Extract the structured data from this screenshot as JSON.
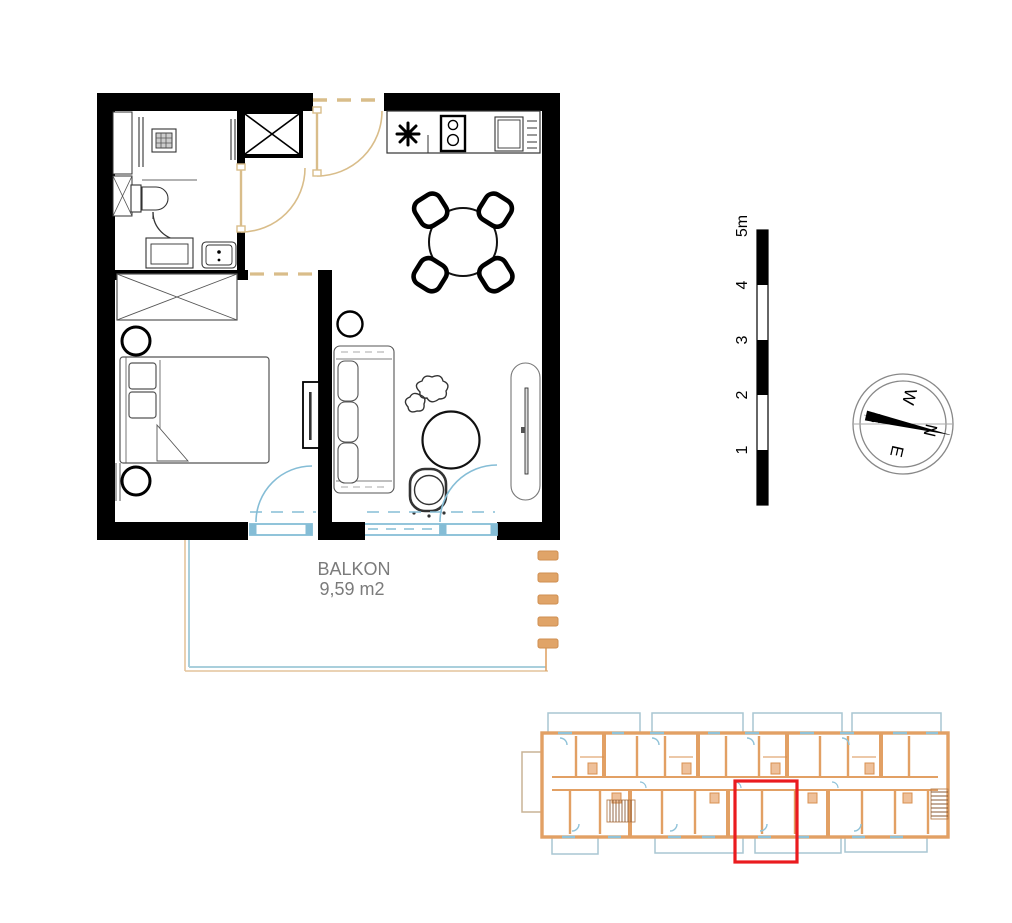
{
  "floor_plan": {
    "balcony_label": "BALKON",
    "balcony_area": "9,59 m2"
  },
  "scale_bar": {
    "labels": [
      "1",
      "2",
      "3",
      "4",
      "5m"
    ]
  },
  "compass": {
    "north": "N",
    "east": "E",
    "south": "S",
    "west": "W"
  },
  "colors": {
    "wall": "#000000",
    "interior_door": "#dcc18e",
    "balcony_door": "#85bdd6",
    "balcony_outline": "#a9cfdc",
    "balcony_rail": "#e0a468",
    "label_text": "#7b7b7b",
    "overview_wall": "#e2a064",
    "overview_door": "#8fc2d8",
    "unit_highlight": "#ea1b1f"
  },
  "icons": {
    "compass": "compass-rose-icon",
    "stove": "stove-burners-icon",
    "boiler": "asterisk-icon",
    "shaft": "crossed-shaft-icon",
    "wardrobe": "crossed-wardrobe-icon"
  }
}
